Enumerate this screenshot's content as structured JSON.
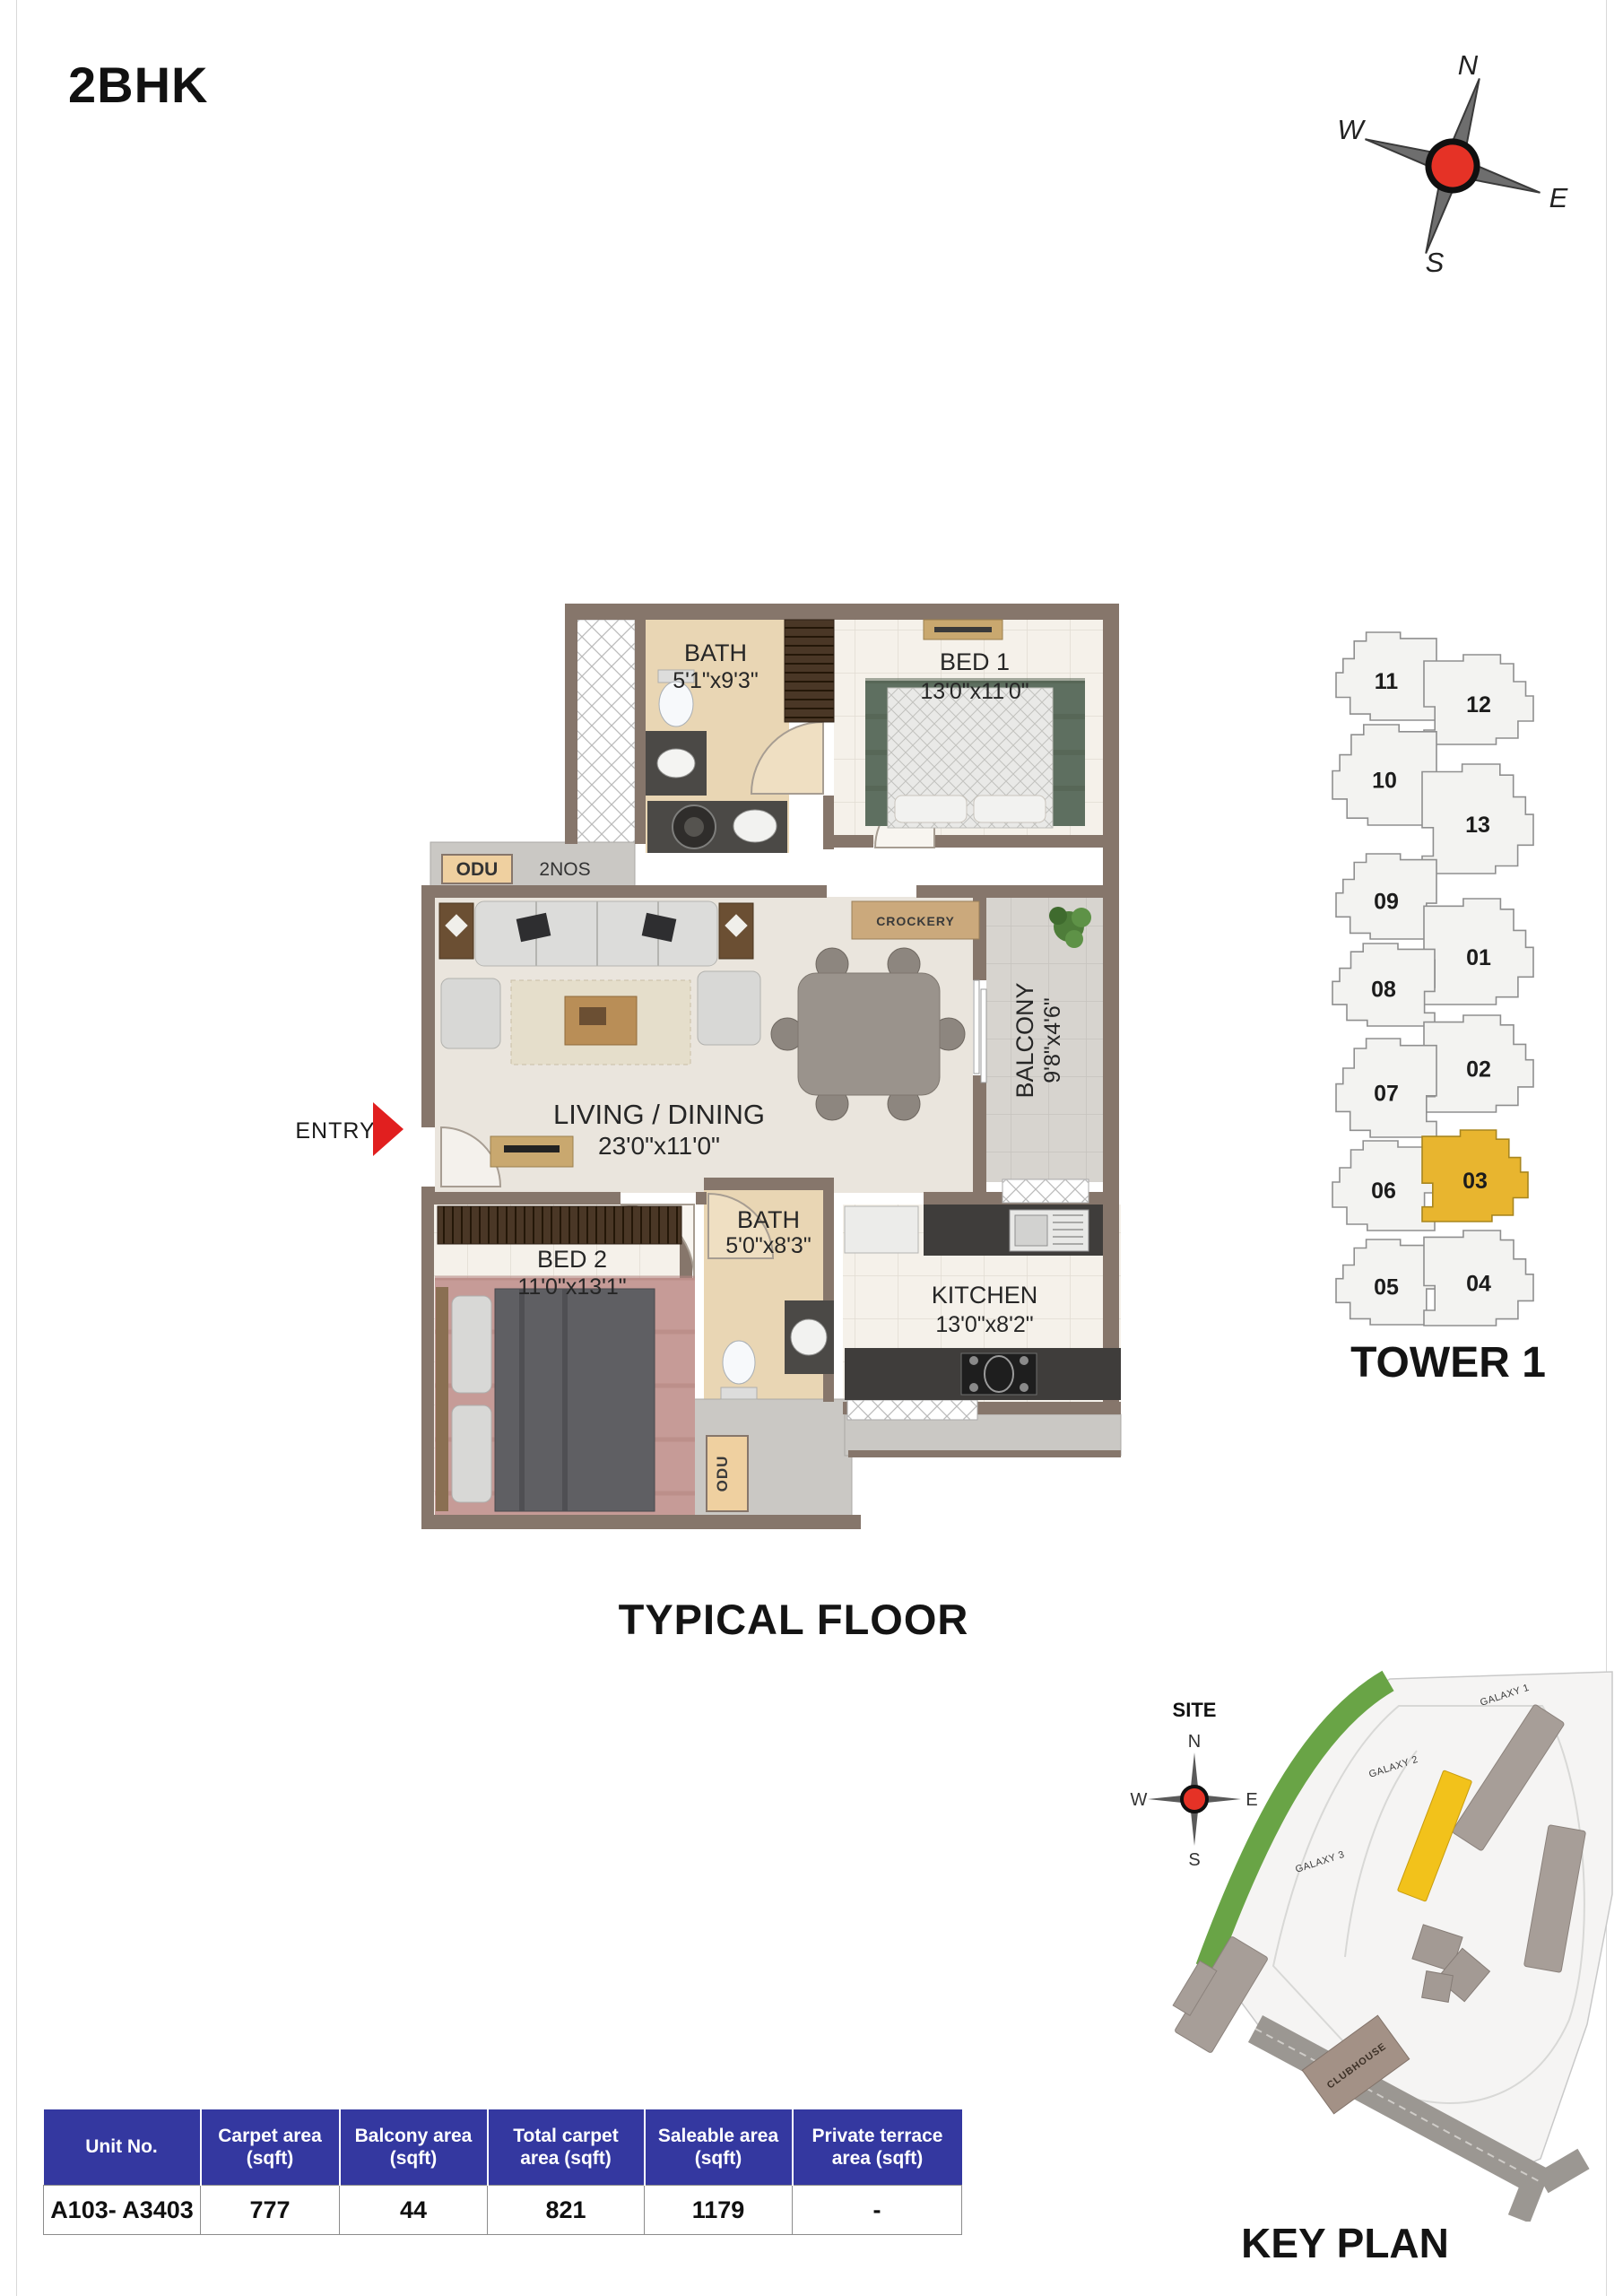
{
  "page": {
    "title": "2BHK",
    "typical_floor": "TYPICAL FLOOR"
  },
  "compass": {
    "north": "N",
    "south": "S",
    "east": "E",
    "west": "W"
  },
  "floor_plan": {
    "entry_label": "ENTRY",
    "odu_label": "ODU",
    "odu_qty": "2NOS",
    "crockery_label": "CROCKERY",
    "utility_odu_label": "ODU",
    "rooms": {
      "bath1": {
        "name": "BATH",
        "dim": "5'1\"x9'3\""
      },
      "bed1": {
        "name": "BED 1",
        "dim": "13'0\"x11'0\""
      },
      "living": {
        "name": "LIVING / DINING",
        "dim": "23'0\"x11'0\""
      },
      "balcony": {
        "name": "BALCONY",
        "dim": "9'8\"x4'6\""
      },
      "bed2": {
        "name": "BED 2",
        "dim": "11'0\"x13'1\""
      },
      "bath2": {
        "name": "BATH",
        "dim": "5'0\"x8'3\""
      },
      "kitchen": {
        "name": "KITCHEN",
        "dim": "13'0\"x8'2\""
      }
    }
  },
  "tower_plan": {
    "label": "TOWER 1",
    "highlight_unit": "03",
    "highlight_color": "#E8B52F",
    "units": [
      "11",
      "12",
      "10",
      "13",
      "09",
      "01",
      "08",
      "02",
      "07",
      "06",
      "03",
      "05",
      "04"
    ]
  },
  "site_plan": {
    "label": "KEY PLAN",
    "site_label": "SITE",
    "galaxy1": "GALAXY 1",
    "galaxy2": "GALAXY 2",
    "galaxy3": "GALAXY 3",
    "clubhouse": "CLUBHOUSE",
    "road": "ROAD",
    "highlight_color": "#F2C21B"
  },
  "area_table": {
    "header_bg": "#3438A0",
    "headers": [
      "Unit No.",
      "Carpet area (sqft)",
      "Balcony area (sqft)",
      "Total carpet area (sqft)",
      "Saleable area (sqft)",
      "Private terrace area (sqft)"
    ],
    "row": {
      "unit_no": "A103- A3403",
      "carpet": "777",
      "balcony": "44",
      "total_carpet": "821",
      "saleable": "1179",
      "private_terrace": "-"
    }
  }
}
